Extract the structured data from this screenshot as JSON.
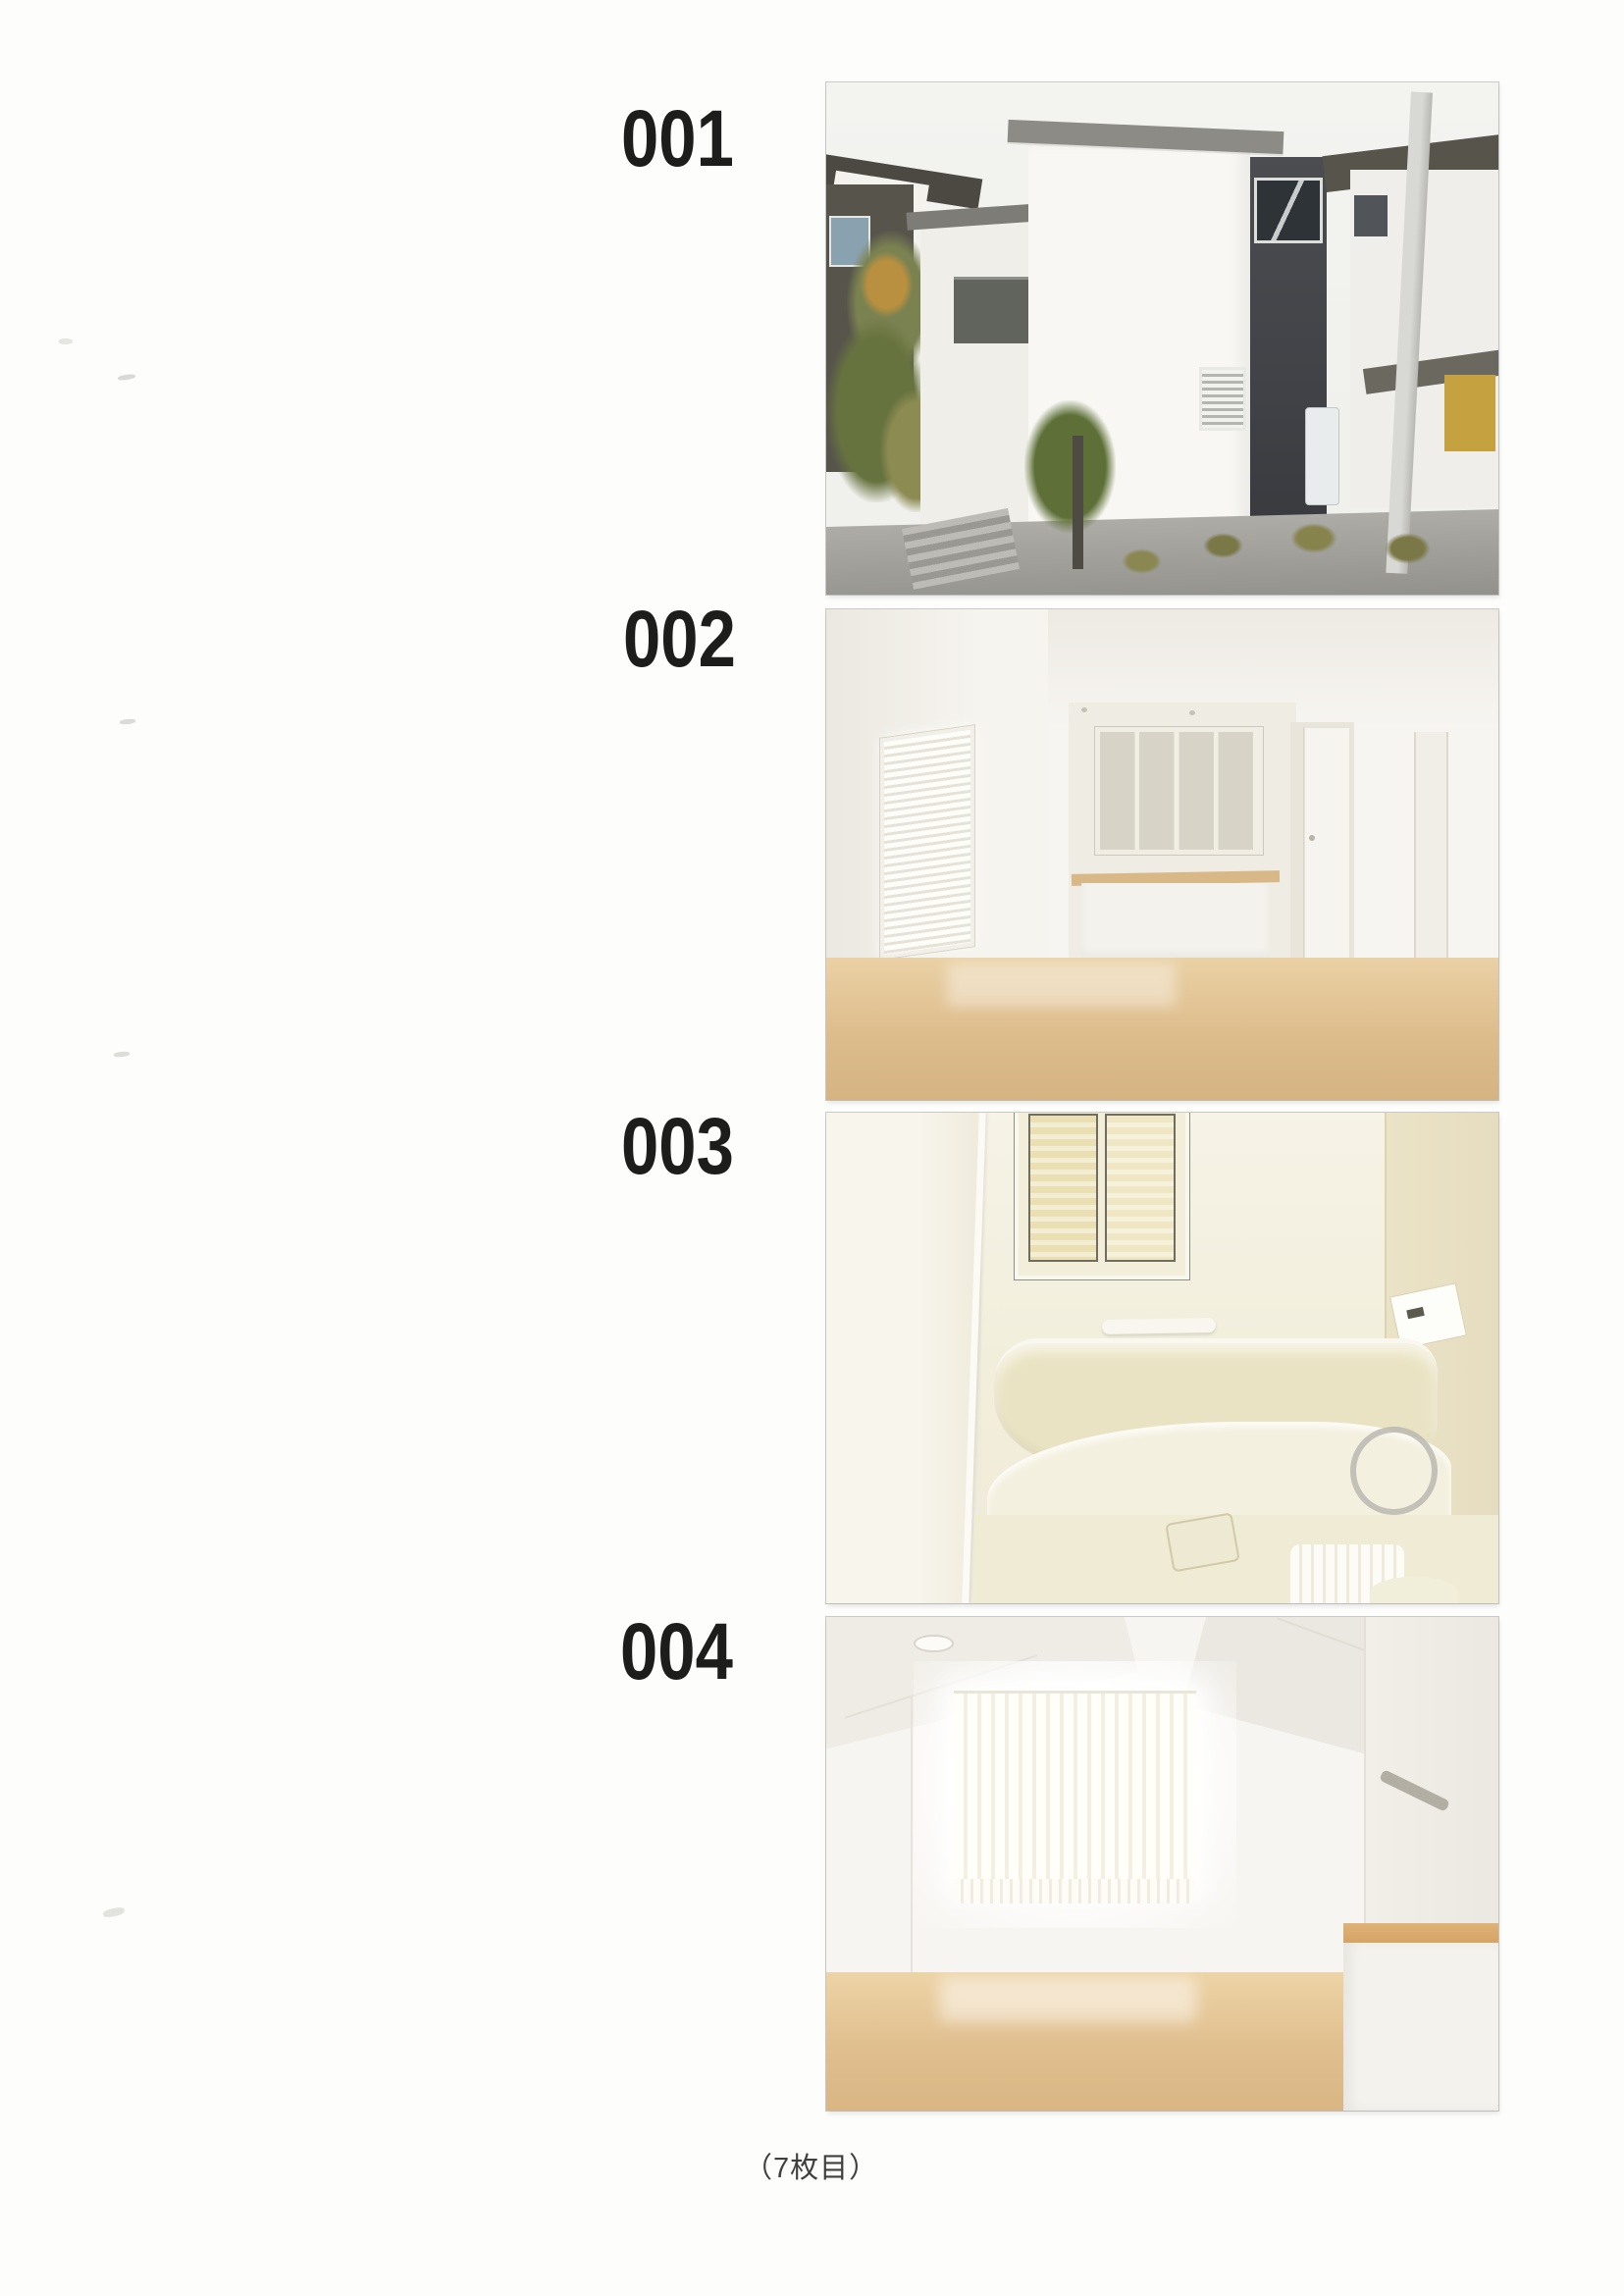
{
  "document": {
    "items": [
      {
        "label": "001",
        "photo": "house-exterior"
      },
      {
        "label": "002",
        "photo": "living-dining-kitchen-interior"
      },
      {
        "label": "003",
        "photo": "unit-bathroom-interior"
      },
      {
        "label": "004",
        "photo": "attic-room-interior"
      }
    ],
    "footer_label": "（7枚目）"
  },
  "colors": {
    "page_background": "#fdfdfc",
    "label_text": "#1d1d1c",
    "footer_text": "#3f3f3e",
    "dark_siding": "#404247",
    "wood_floor": "#ddbc8c",
    "bath_cream": "#f2eedb"
  }
}
